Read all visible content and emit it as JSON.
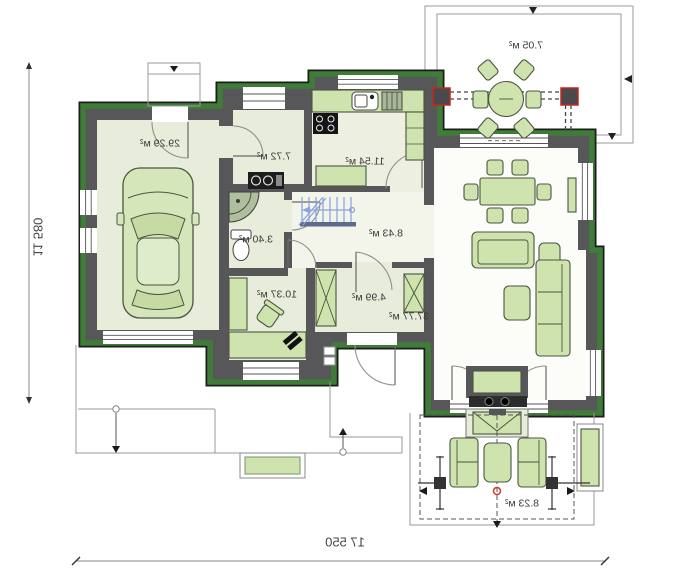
{
  "plan": {
    "rooms": [
      {
        "name": "garage",
        "area": "29.29 м²"
      },
      {
        "name": "utility",
        "area": "7.72 м²"
      },
      {
        "name": "kitchen",
        "area": "11.54 м²"
      },
      {
        "name": "hall",
        "area": "8.43 м²"
      },
      {
        "name": "bathroom",
        "area": "3.40 м²"
      },
      {
        "name": "office",
        "area": "10.37 м²"
      },
      {
        "name": "vestibule",
        "area": "4.99 м²"
      },
      {
        "name": "living-room",
        "area": "37.77 м²"
      },
      {
        "name": "terrace-top",
        "area": "7.05 м²"
      },
      {
        "name": "terrace-bottom",
        "area": "8.23 м²"
      }
    ],
    "dimensions": {
      "overall_width": "17 550",
      "overall_depth": "11 580"
    },
    "colors": {
      "wall": "#57575a",
      "facade_trim": "#3e7c38",
      "room_floor": "#e7edda",
      "furniture": "#cfe3af",
      "stairs": "#8ba2dd",
      "post_accent": "#c4281c"
    }
  }
}
